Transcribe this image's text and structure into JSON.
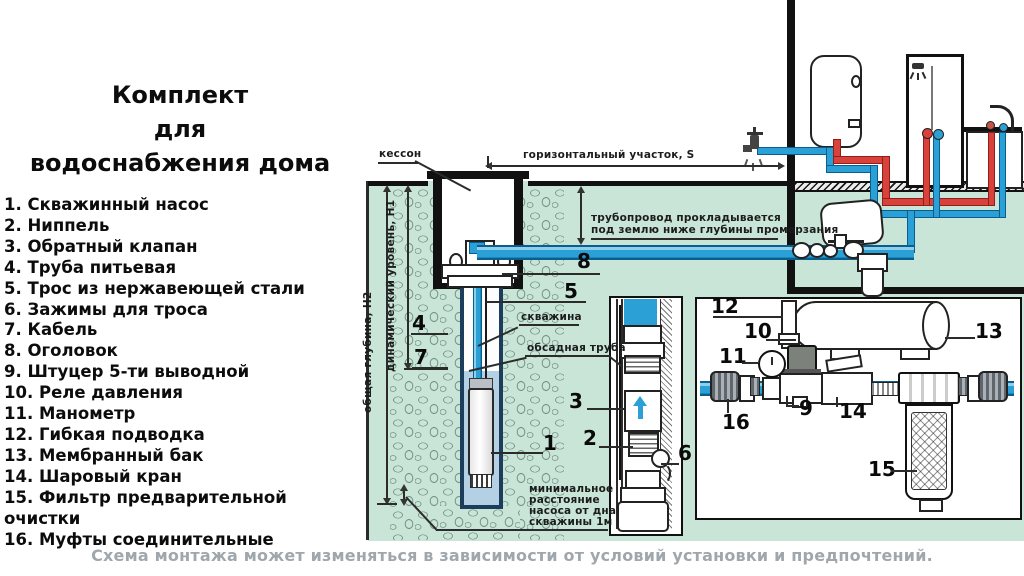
{
  "title": "Комплект\nдля\nводоснабжения дома",
  "legend": {
    "items": [
      {
        "num": "1",
        "label": "Скважинный насос"
      },
      {
        "num": "2",
        "label": "Ниппель"
      },
      {
        "num": "3",
        "label": "Обратный клапан"
      },
      {
        "num": "4",
        "label": "Труба питьевая"
      },
      {
        "num": "5",
        "label": "Трос из нержавеющей стали"
      },
      {
        "num": "6",
        "label": "Зажимы для троса"
      },
      {
        "num": "7",
        "label": "Кабель"
      },
      {
        "num": "8",
        "label": "Оголовок"
      },
      {
        "num": "9",
        "label": "Штуцер 5-ти выводной"
      },
      {
        "num": "10",
        "label": "Реле давления"
      },
      {
        "num": "11",
        "label": "Манометр"
      },
      {
        "num": "12",
        "label": "Гибкая подводка"
      },
      {
        "num": "13",
        "label": "Мембранный бак"
      },
      {
        "num": "14",
        "label": "Шаровый кран"
      },
      {
        "num": "15",
        "label": "Фильтр предварительной очистки"
      },
      {
        "num": "16",
        "label": "Муфты соединительные"
      }
    ]
  },
  "labels": {
    "kesson": "кессон",
    "horizontal_section": "горизонтальный участок,  S",
    "pipe_note": "трубопровод прокладывается\nпод землю ниже глубины промерзания",
    "total_depth": "общая глубина, Н2",
    "dynamic_level": "динамический уровень, Н1",
    "borehole": "скважина",
    "casing_pipe": "обсадная труба",
    "min_distance": "минимальное\nрасстояние\nнасоса от дна\nскважины 1м"
  },
  "callouts": {
    "c1": "1",
    "c2": "2",
    "c3": "3",
    "c4": "4",
    "c5": "5",
    "c6": "6",
    "c7": "7",
    "c8": "8",
    "c9": "9",
    "c10": "10",
    "c11": "11",
    "c12": "12",
    "c13": "13",
    "c14": "14",
    "c15": "15",
    "c16": "16"
  },
  "caption": "Схема монтажа может изменяться в зависимости от условий установки и предпочтений.",
  "colors": {
    "ground_green": "#c8e5d8",
    "pipe_blue": "#2aa0d6",
    "pipe_blue_dark": "#0b5d8c",
    "pipe_red": "#d9423a",
    "well_water": "#b3d0e5",
    "shaft_border": "#1d3d5c",
    "caption_gray": "#9fa7ac",
    "ink": "#141414"
  }
}
